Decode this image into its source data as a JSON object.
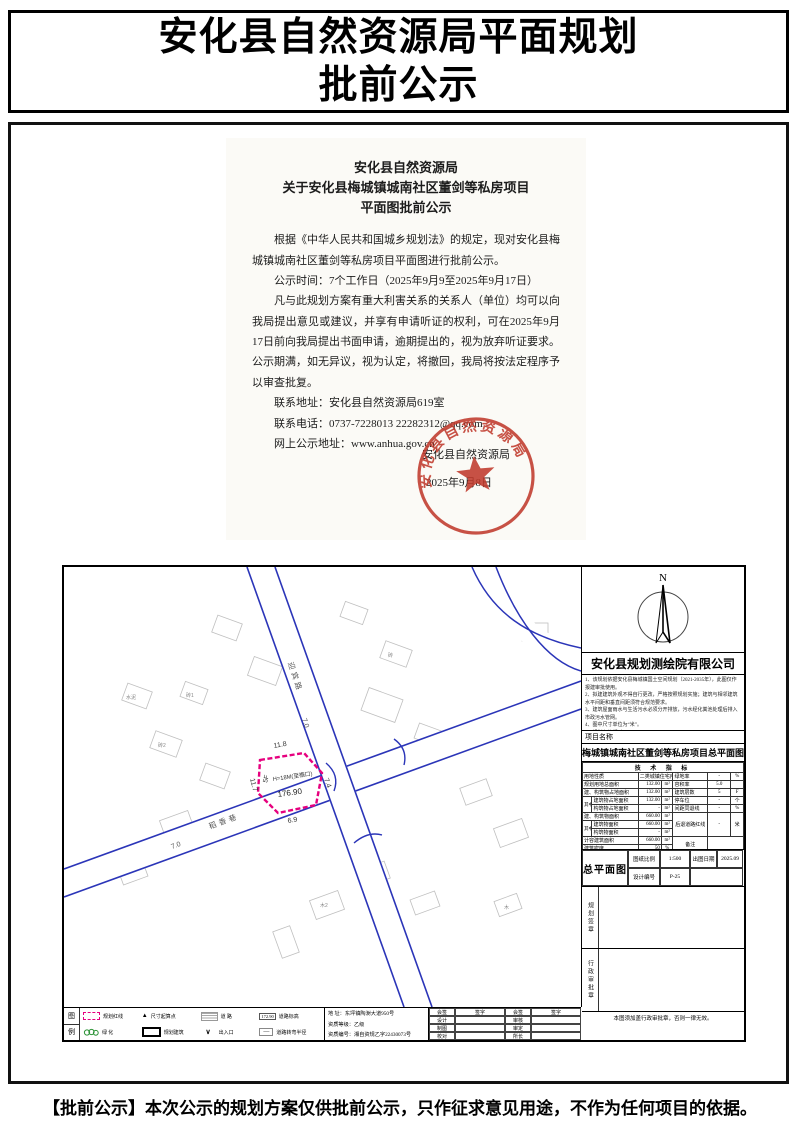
{
  "page": {
    "title_line1": "安化县自然资源局平面规划",
    "title_line2": "批前公示",
    "footer_note": "【批前公示】本次公示的规划方案仅供批前公示，只作征求意见用途，不作为任何项目的依据。"
  },
  "notice": {
    "title_line1": "安化县自然资源局",
    "title_line2": "关于安化县梅城镇城南社区董剑等私房项目",
    "title_line3": "平面图批前公示",
    "para1": "根据《中华人民共和国城乡规划法》的规定，现对安化县梅城镇城南社区董剑等私房项目平面图进行批前公示。",
    "para2": "公示时间：7个工作日（2025年9月9至2025年9月17日）",
    "para3": "凡与此规划方案有重大利害关系的关系人（单位）均可以向我局提出意见或建议，并享有申请听证的权利，可在2025年9月17日前向我局提出书面申请，逾期提出的，视为放弃听证要求。公示期满，如无异议，视为认定，将撤回，我局将按法定程序予以审查批复。",
    "contact_address": "联系地址：安化县自然资源局619室",
    "contact_phone": "联系电话：0737-7228013    22282312@qq.com",
    "contact_web": "网上公示地址：www.anhua.gov.cn",
    "sign_agency": "安化县自然资源局",
    "sign_date": "2025年9月8日",
    "seal_text": "安化县自然资源局",
    "seal_color": "#c0392b"
  },
  "plan": {
    "north_label": "N",
    "company": "安化县规划测绘院有限公司",
    "notes": [
      "1、该规划依据安化县梅城镇国土空间规划（2021-2035年），此图仅作报建审批使用。",
      "2、拟建建筑外观不得自行更改，严格按照规划实施；建筑与相邻建筑水平间距和垂直间距须符合规范要求。",
      "3、建筑屋面雨水与生活污水必须分开排放，污水经化粪池处理后排入市政污水管网。",
      "4、图中尺寸单位为“米”。",
      "5、规划有效期2年。"
    ],
    "project_label": "项目名称",
    "project_name": "梅城镇城南社区董剑等私房项目总平面图",
    "tech": {
      "header": "技 术 指 标",
      "qizhong": "其中",
      "r1": [
        "用地性质",
        "二类城镇住宅用地",
        "绿地率",
        "-",
        "%"
      ],
      "r2": [
        "规划用地总面积",
        "132.00",
        "m²",
        "容积率",
        "5.0",
        ""
      ],
      "r3": [
        "建、构筑物占地面积",
        "132.00",
        "m²",
        "建筑层数",
        "5",
        "F"
      ],
      "r4": [
        "建筑物占地面积",
        "132.00",
        "m²",
        "停车位",
        "-",
        "个"
      ],
      "r5": [
        "构筑物占地面积",
        "-",
        "m²",
        "间距同退线",
        "-",
        "%"
      ],
      "r6": [
        "建、构筑物面积",
        "660.00",
        "m²",
        "后退道路红线",
        "-",
        "米"
      ],
      "r7": [
        "建筑物面积",
        "660.00",
        "m²"
      ],
      "r8": [
        "构筑物面积",
        "-",
        "m²"
      ],
      "r9": [
        "计容建筑面积",
        "660.00",
        "m²",
        "备注"
      ],
      "r10": [
        "建筑密度",
        "50",
        "%"
      ]
    },
    "titleblock": {
      "drawing_name": "总平面图",
      "scale_label": "图纸比例",
      "scale": "1:500",
      "date_label": "出图日期",
      "date": "2025.09",
      "design_label": "设计编号",
      "design_no": "P-25"
    },
    "seal_box1": "规划签章",
    "seal_box2": "行政审批章",
    "validity_note": "本图须加盖行政审批章，否则一律无效。",
    "legend": {
      "label_top": "图",
      "label_bottom": "例",
      "r1": [
        {
          "label": "规划红线"
        },
        {
          "label": "尺寸起算点",
          "glyph": "▲"
        },
        {
          "label": "道  路"
        },
        {
          "label": "道路标高",
          "sample": "172.90"
        }
      ],
      "r2": [
        {
          "label": "绿  化"
        },
        {
          "label": "规划建筑"
        },
        {
          "label": "出入口",
          "glyph": "∨"
        },
        {
          "label": "道路转弯半径",
          "glyph": "—"
        }
      ]
    },
    "office": {
      "address": "地  址：东坪镇陶澍大道950号",
      "grade": "资质等级：乙级",
      "cert": "资质编号：湘自资规乙字22430073号"
    },
    "signtable": {
      "r1": [
        "会签",
        "签字",
        "会签",
        "签字"
      ],
      "r2": [
        "设计",
        "",
        "审核",
        ""
      ],
      "r3": [
        "制图",
        "",
        "审定",
        ""
      ],
      "r4": [
        "校对",
        "",
        "所长",
        ""
      ]
    },
    "map": {
      "road1_name": "迎宾路",
      "road1_width": "7.0",
      "road2_name": "稻香巷",
      "road2_width": "7.0",
      "plot": {
        "floors": "5F",
        "height": "H=18M(至檐口)",
        "elevation": "176.90",
        "dim_top": "11.8",
        "dim_left": "11.7",
        "dim_bottom": "6.9",
        "dim_right": "7.4"
      },
      "bldg_labels": [
        "砖1",
        "砖2",
        "木2",
        "水泥",
        "砖",
        "木"
      ]
    }
  }
}
